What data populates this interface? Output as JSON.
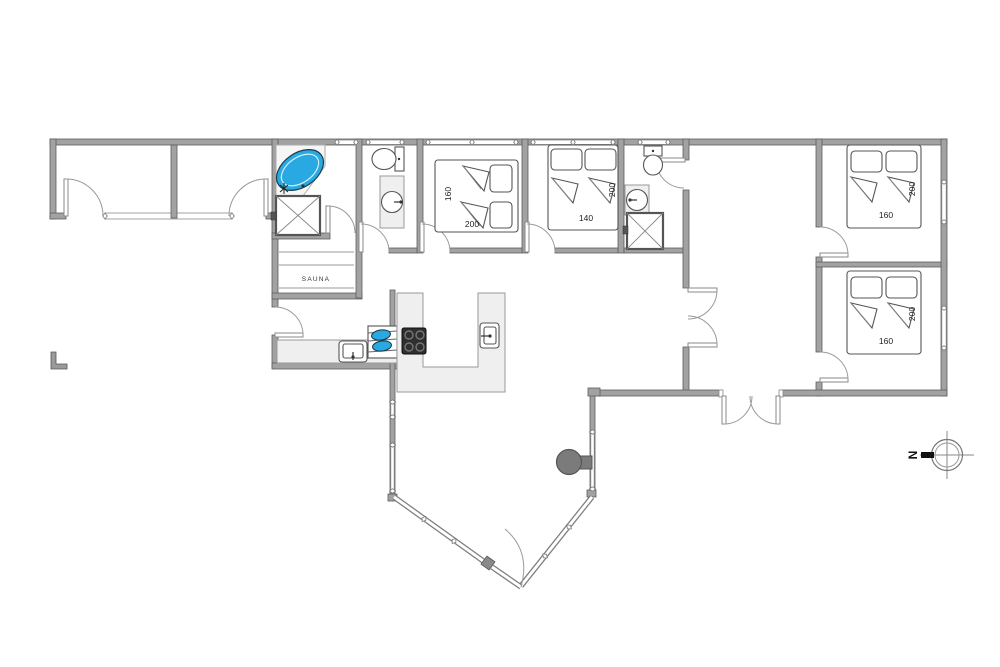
{
  "plan": {
    "type": "holiday-house-floor-plan",
    "labels": {
      "sauna": "SAUNA",
      "compass_north": "N"
    },
    "beds": [
      {
        "room": "bedroom-west",
        "width_cm": "160",
        "length_cm": "200"
      },
      {
        "room": "bedroom-middle",
        "width_cm": "140",
        "length_cm": "200"
      },
      {
        "room": "bedroom-northeast",
        "width_cm": "160",
        "length_cm": "200"
      },
      {
        "room": "bedroom-southeast",
        "width_cm": "160",
        "length_cm": "200"
      }
    ],
    "fixtures": [
      "corner-bathtub",
      "shower",
      "toilet",
      "washbasin",
      "sauna-benches",
      "kitchen-island",
      "cooktop",
      "two-burner-hob",
      "kitchen-sink",
      "wood-stove",
      "double-entrance-door",
      "bay-window",
      "carport-sheds",
      "compass-rose",
      "terrace-corner-marker"
    ],
    "colors": {
      "wall_fill": "#a2a2a2",
      "wall_stroke": "#5e5e5e",
      "counter_fill": "#efefef",
      "tub_blue": "#29a9e1",
      "cooktop_dark": "#2f2f2f",
      "stove_gray": "#7b7b7b",
      "label_text": "#222222"
    }
  }
}
